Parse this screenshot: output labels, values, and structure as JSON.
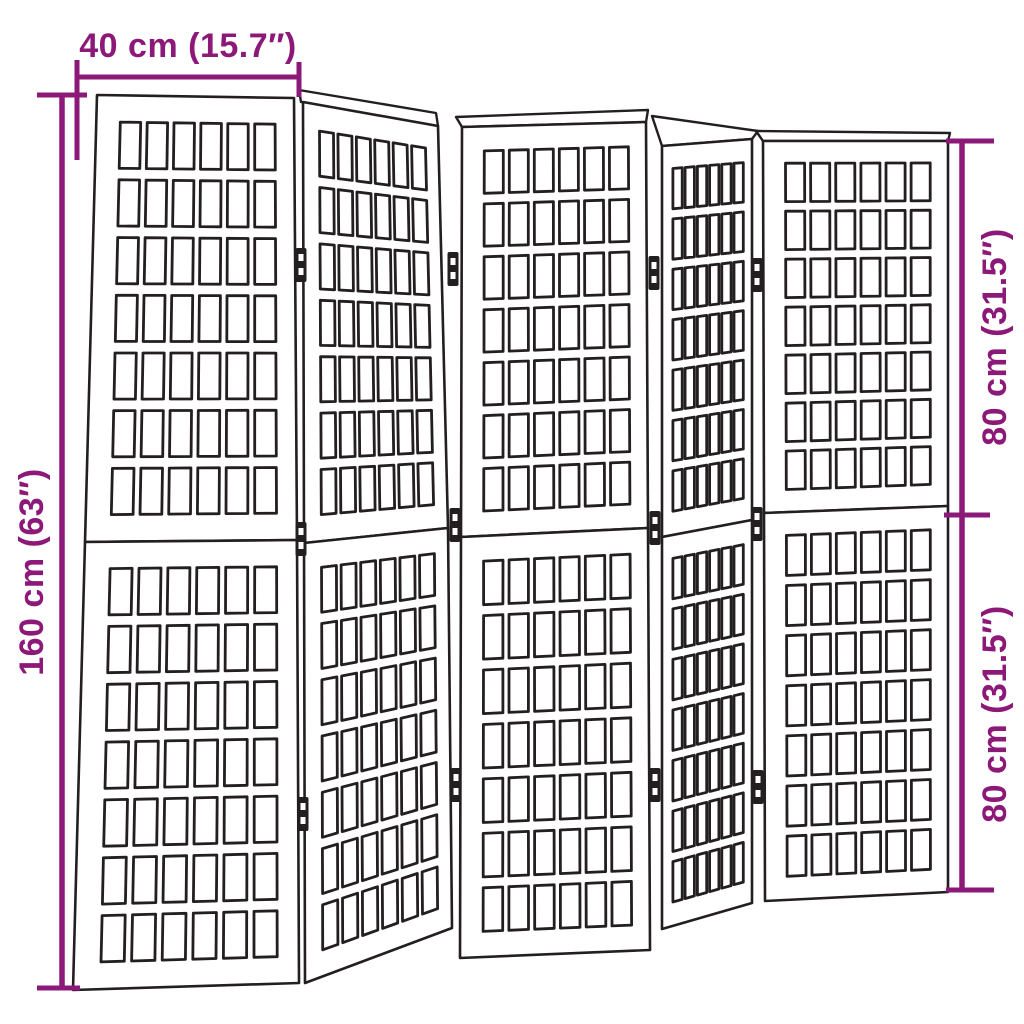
{
  "diagram": {
    "title": "Room divider dimension diagram",
    "product": "5-panel folding room divider with lattice screen panels",
    "colors": {
      "accent": "#8C1978",
      "line": "#231f20",
      "panel_fill": "#ffffff",
      "background": "#ffffff"
    },
    "dimensions": {
      "width": {
        "label": "40 cm (15.7″)",
        "value_cm": 40,
        "value_in": 15.7,
        "position": "top"
      },
      "total_height": {
        "label": "160 cm (63″)",
        "value_cm": 160,
        "value_in": 63,
        "position": "left"
      },
      "upper_section": {
        "label": "80 cm (31.5″)",
        "value_cm": 80,
        "value_in": 31.5,
        "position": "right-top"
      },
      "lower_section": {
        "label": "80 cm (31.5″)",
        "value_cm": 80,
        "value_in": 31.5,
        "position": "right-bottom"
      }
    },
    "structure": {
      "panel_count": 5,
      "sections_per_panel": 2,
      "lattice_columns": 6,
      "lattice_rows_per_section": 7,
      "hinge_count": 12
    }
  }
}
